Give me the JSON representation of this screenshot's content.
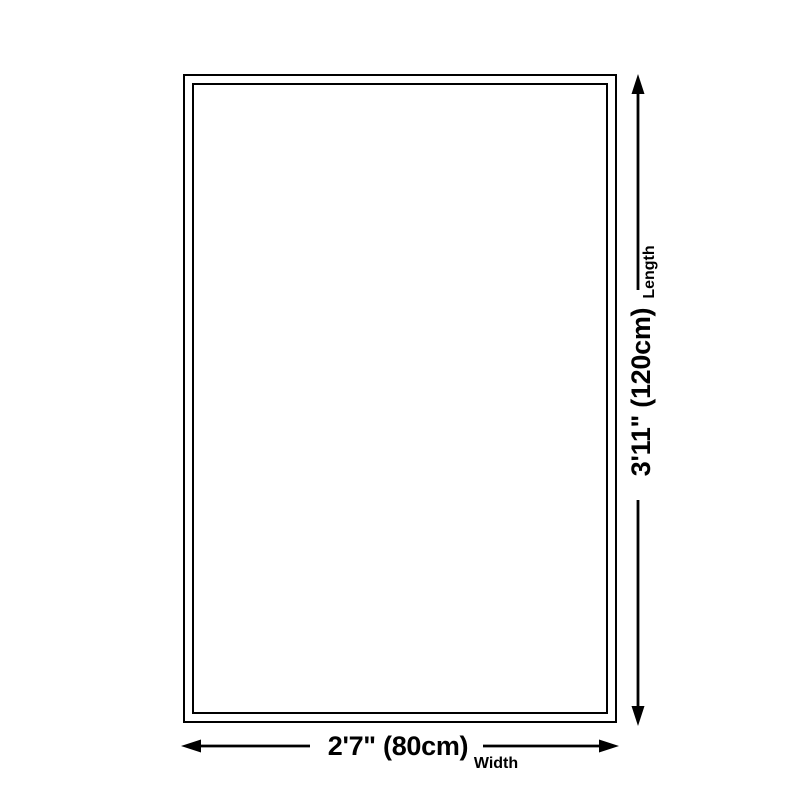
{
  "theme": {
    "background": "#ffffff",
    "line": "#000000",
    "text": "#000000"
  },
  "diagram": {
    "type": "product-size-diagram",
    "length": {
      "value": "3'11\" (120cm)",
      "label": "Length"
    },
    "width": {
      "value": "2'7\" (80cm)",
      "label": "Width"
    }
  }
}
